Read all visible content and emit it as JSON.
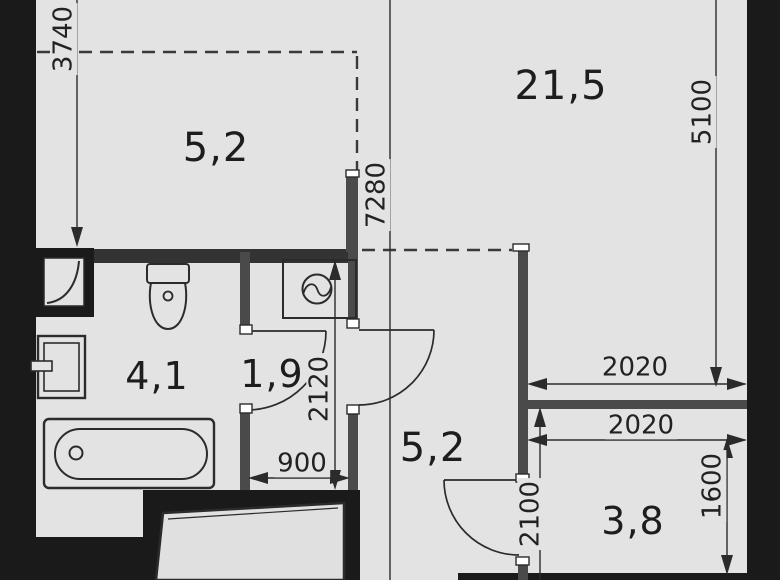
{
  "plan": {
    "type": "apartment-floor-plan",
    "units": {
      "areas": "m2",
      "dimensions": "mm"
    },
    "rooms": [
      {
        "name": "kitchen-niche",
        "area_label": "5,2"
      },
      {
        "name": "living-room",
        "area_label": "21,5"
      },
      {
        "name": "bathroom",
        "area_label": "4,1"
      },
      {
        "name": "laundry-niche",
        "area_label": "1,9"
      },
      {
        "name": "hallway",
        "area_label": "5,2"
      },
      {
        "name": "wardrobe-room",
        "area_label": "3,8"
      }
    ],
    "dims": [
      {
        "name": "dim-3740",
        "label": "3740"
      },
      {
        "name": "dim-7280",
        "label": "7280"
      },
      {
        "name": "dim-5100",
        "label": "5100"
      },
      {
        "name": "dim-2120",
        "label": "2120"
      },
      {
        "name": "dim-900",
        "label": "900"
      },
      {
        "name": "dim-2020-top",
        "label": "2020"
      },
      {
        "name": "dim-2020-bottom",
        "label": "2020"
      },
      {
        "name": "dim-2100",
        "label": "2100"
      },
      {
        "name": "dim-1600",
        "label": "1600"
      }
    ],
    "fixtures": [
      "vent-shaft",
      "toilet",
      "sink",
      "bathtub",
      "washing-machine"
    ],
    "doors": [
      "bathroom-door",
      "laundry-door",
      "wardrobe-door"
    ],
    "colors": {
      "floor": "#e3e3e3",
      "outer_wall": "#1a1a1a",
      "inner_wall": "#4a4a4a",
      "line": "#2b2b2b",
      "text": "#1d1d1d"
    }
  }
}
